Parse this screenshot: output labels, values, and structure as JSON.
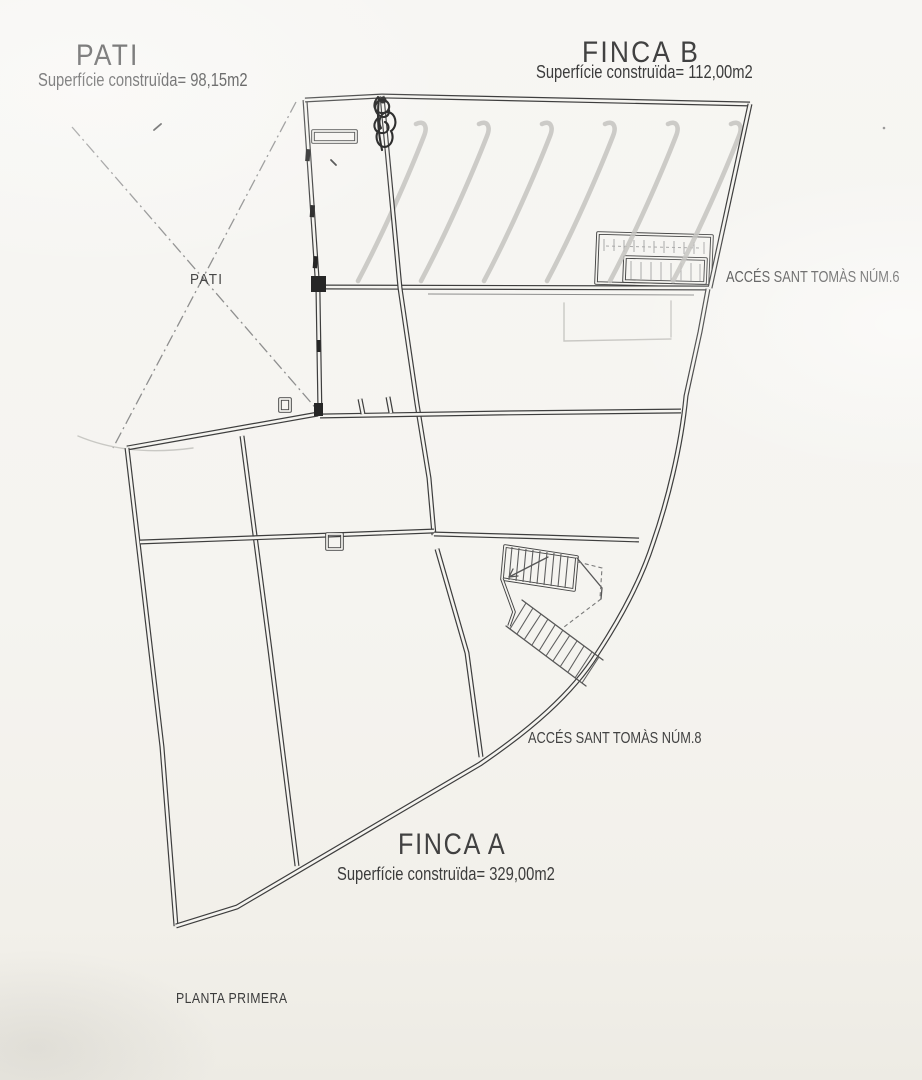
{
  "plan": {
    "pati": {
      "title": "PATI",
      "area": "Superfície construïda= 98,15m2",
      "courtyard_label": "PATI"
    },
    "finca_b": {
      "title": "FINCA B",
      "area": "Superfície construïda= 112,00m2"
    },
    "finca_a": {
      "title": "FINCA A",
      "area": "Superfície construïda= 329,00m2"
    },
    "access_num6": "ACCÉS SANT TOMÀS NÚM.6",
    "access_num8": "ACCÉS SANT TOMÀS NÚM.8",
    "floor_label": "PLANTA PRIMERA"
  },
  "colors": {
    "paper": "#f5f4f0",
    "ink": "#3e3e3e",
    "pencil_hatch": "#c4c3bf",
    "text": "#3c3c3c"
  }
}
